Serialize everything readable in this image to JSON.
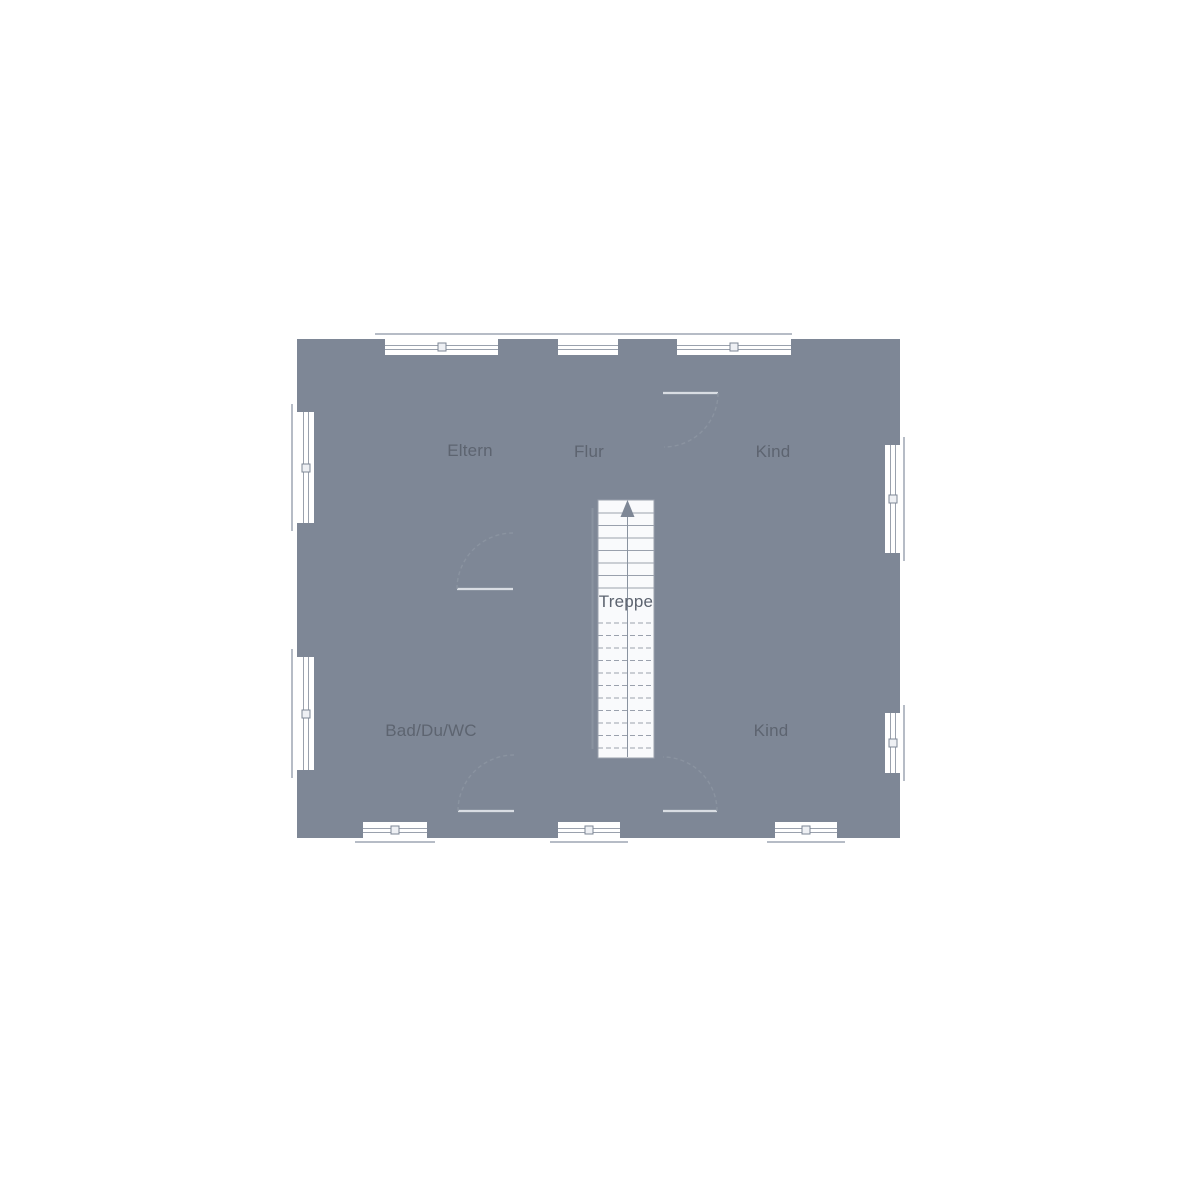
{
  "floorplan": {
    "labels": {
      "eltern": "Eltern",
      "flur": "Flur",
      "kind_top": "Kind",
      "treppe": "Treppe",
      "bad": "Bad/Du/WC",
      "kind_bottom": "Kind"
    },
    "colors": {
      "wall": "#7e8796",
      "floor": "#e9ecf1",
      "outside": "#ffffff",
      "furniture_light": "#d3d8df",
      "furniture_medium": "#c7ccd5",
      "furniture_dark": "#adb4c1",
      "stairs_fill": "#f9fafc",
      "line": "#9aa1ad",
      "door_line": "#8a93a0",
      "text": "#5d6470"
    }
  }
}
